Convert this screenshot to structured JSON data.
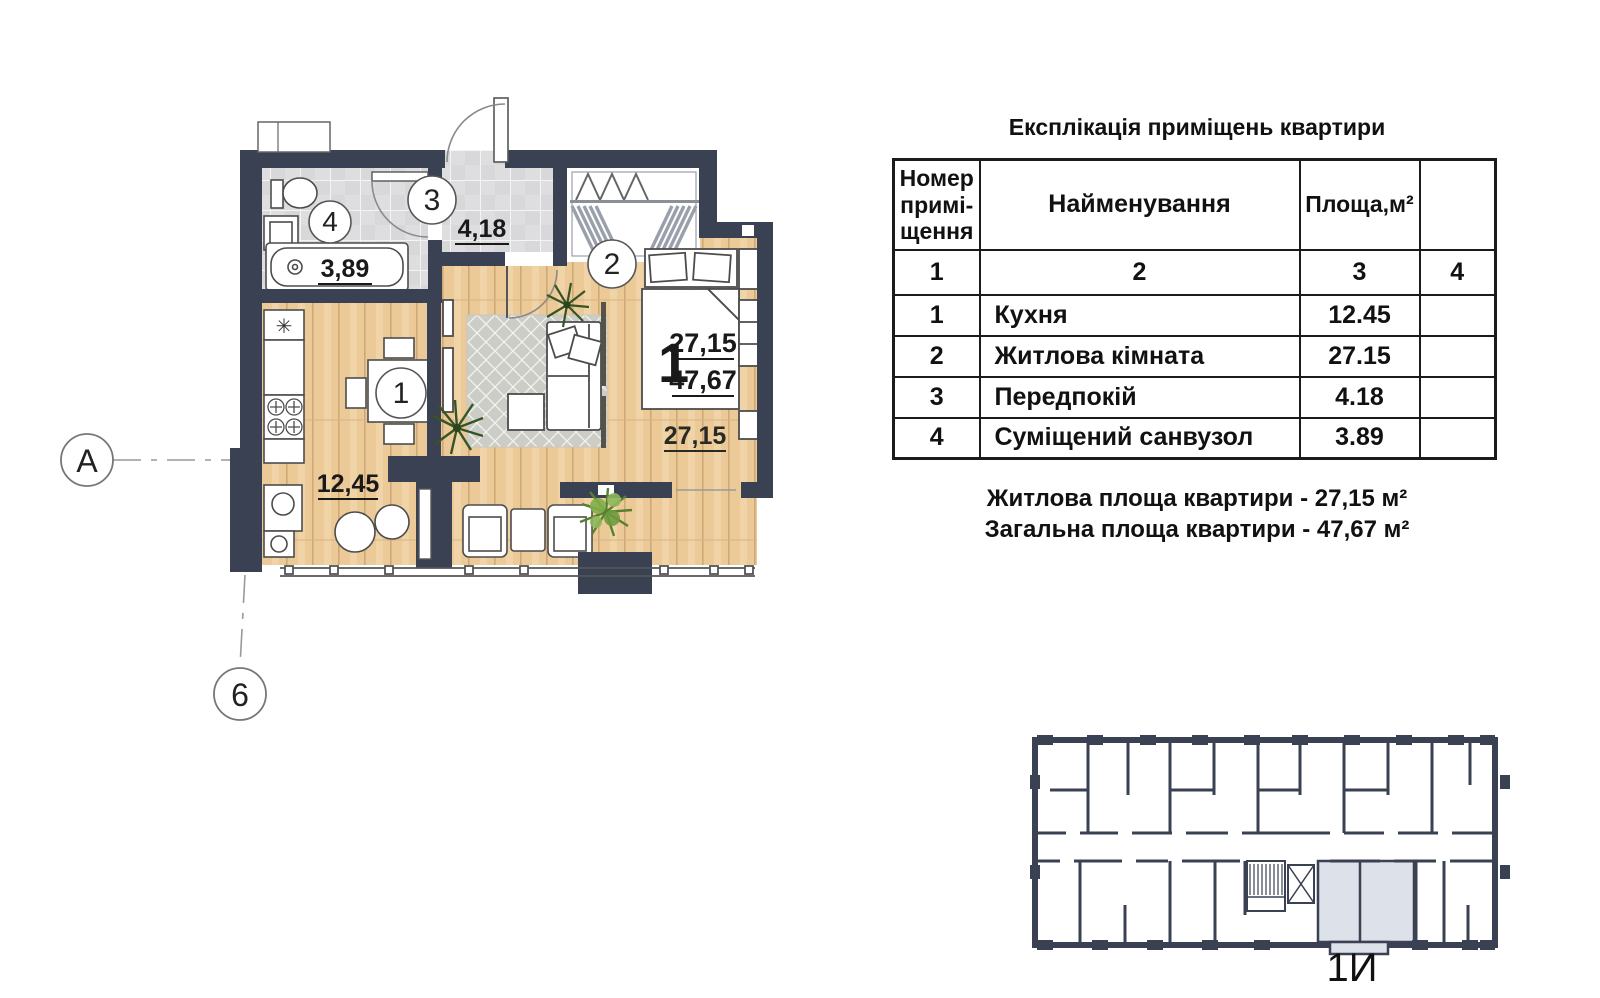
{
  "plan": {
    "axis_markers": [
      {
        "label": "А"
      },
      {
        "label": "6"
      }
    ],
    "rooms": [
      {
        "circle": "1",
        "area_label": "12,45"
      },
      {
        "circle": "2",
        "area_label": "27,15"
      },
      {
        "circle": "3",
        "area_label": "4,18"
      },
      {
        "circle": "4",
        "area_label": "3,89"
      }
    ],
    "apartment_tag": {
      "type_number": "1",
      "living": "27,15",
      "total": "47,67"
    },
    "fridge_symbol": "✳"
  },
  "explication": {
    "title": "Експлікація приміщень квартири",
    "header": {
      "number": "Номер\nпримі-\nщення",
      "name": "Найменування",
      "area": "Площа,м²",
      "extra": ""
    },
    "column_numbers": [
      "1",
      "2",
      "3",
      "4"
    ],
    "rows": [
      {
        "num": "1",
        "name": "Кухня",
        "area": "12.45",
        "extra": ""
      },
      {
        "num": "2",
        "name": "Житлова кімната",
        "area": "27.15",
        "extra": ""
      },
      {
        "num": "3",
        "name": "Передпокій",
        "area": "4.18",
        "extra": ""
      },
      {
        "num": "4",
        "name": "Суміщений санвузол",
        "area": "3.89",
        "extra": ""
      }
    ],
    "summary": [
      "Житлова площа квартири - 27,15 м²",
      "Загальна площа квартири - 47,67 м²"
    ]
  },
  "key_plan": {
    "unit_label": "1И"
  },
  "colors": {
    "wall": "#3a4152",
    "wood": "#ecca97",
    "tile": "#d8d8da",
    "highlight": "#dde1ea"
  }
}
